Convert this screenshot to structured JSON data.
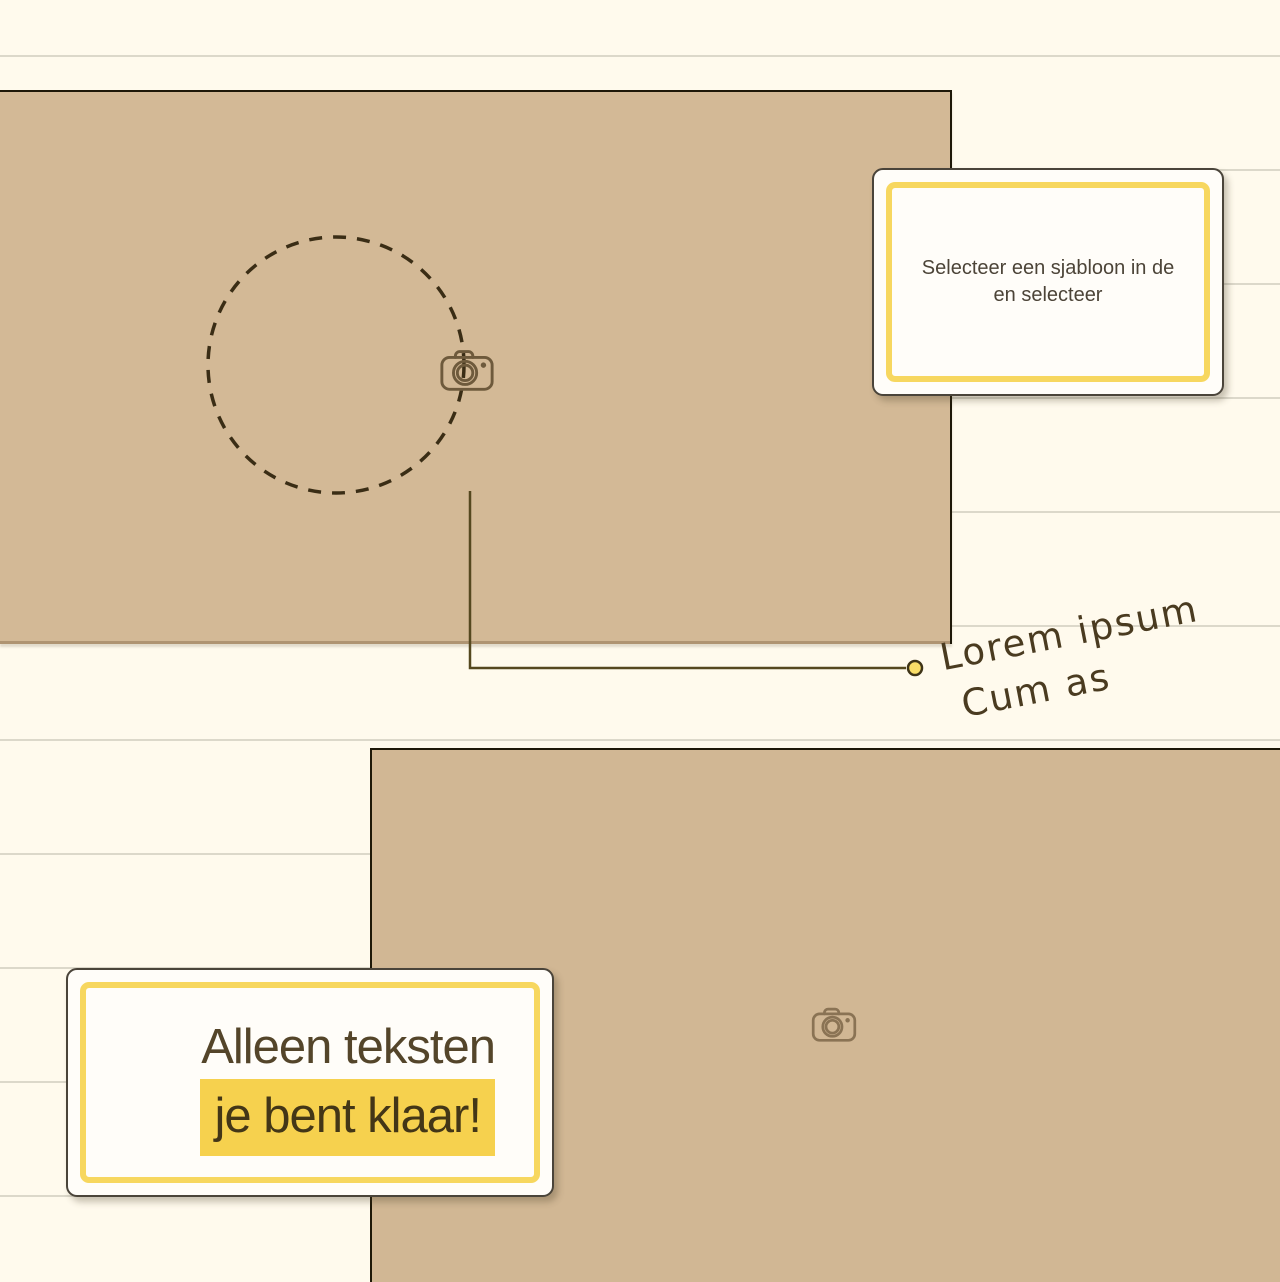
{
  "annotation": {
    "line1": "Lorem ipsum",
    "line2": "Cum as"
  },
  "cards": {
    "template_hint": {
      "line1": "Selecteer een sjabloon in de",
      "line2": "en selecteer"
    },
    "done_hint": {
      "line1": "Alleen teksten",
      "line2": "je bent klaar!"
    }
  },
  "icons": {
    "camera_top": "camera-icon",
    "camera_bottom": "camera-icon",
    "connector_dot": "connector-dot",
    "dashed_circle": "dashed-circle-marker"
  },
  "colors": {
    "accent_yellow_border": "#F7D75F",
    "highlight_yellow": "#F6D14E",
    "connector_dot_fill": "#FADE68",
    "tan_placeholder": "#D3B996",
    "cream_background": "#FFFAED",
    "ruled_line": "#DCD8CA",
    "ink_outline": "#1E1808",
    "handwriting_ink": "#4A3B20",
    "card_text": "#4C4438"
  }
}
